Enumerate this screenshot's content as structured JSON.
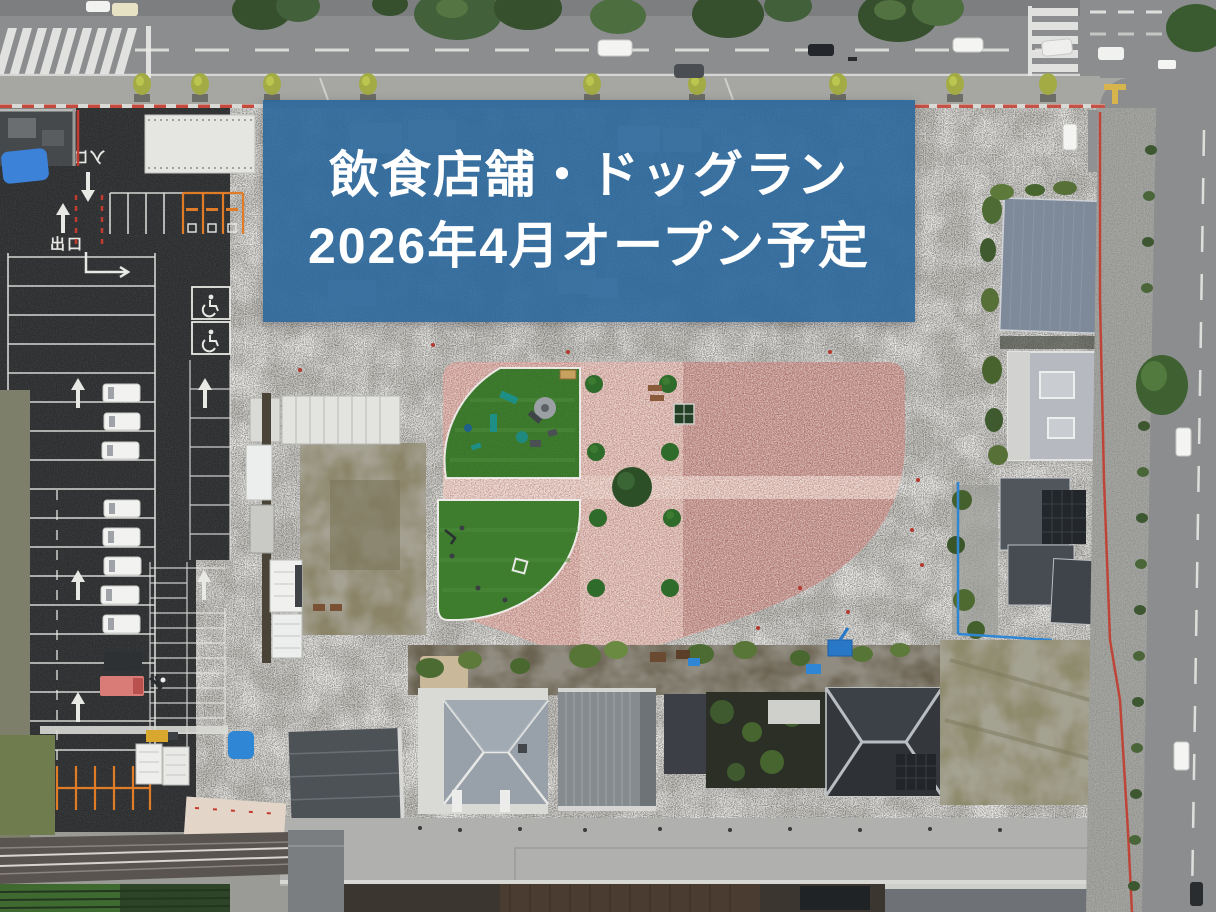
{
  "banner": {
    "line1": "飲食店舗・ドッグラン",
    "line2": "2026年4月オープン予定",
    "bg_color": "#2a679b",
    "text_color": "#ffffff"
  },
  "road_markings": {
    "exit_label": "出口",
    "entrance_label": "入口"
  },
  "icons": {
    "wheelchair_marking": "painted-wheelchair-stall-symbol",
    "lane_arrow": "painted-straight-arrow"
  },
  "palette": {
    "road": "#8b8d8f",
    "sidewalk": "#a6a7a3",
    "asphalt": "#2b2d2f",
    "gravel": "#ecebe8",
    "plaza": "#d6a69e",
    "plaza-dark": "#bf8a83",
    "dogrun": "#3e7d2e",
    "olive": "#8b8468",
    "curb-red": "#c23b2e",
    "tarp-blue": "#2f86d4",
    "banner-text": "#ffffff"
  }
}
